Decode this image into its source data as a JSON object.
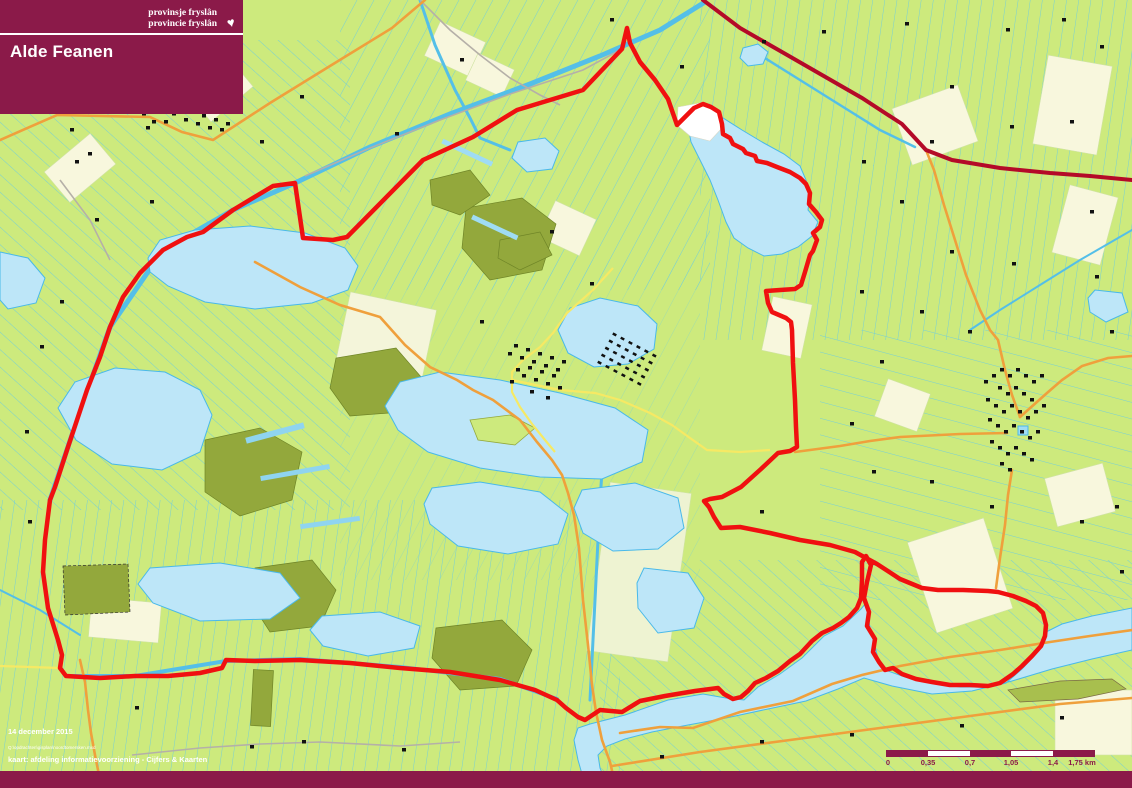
{
  "header": {
    "logo_line1": "provinsje fryslân",
    "logo_line2": "provincie fryslân",
    "heart_icon": "♥",
    "title": "Alde Feanen"
  },
  "footer": {
    "date": "14 december 2015",
    "source_path": "Q:\\opdrachten\\gisplan\\noordtomersken.mxd",
    "credit": "kaart: afdeling informatievoorziening - Cijfers & Kaarten"
  },
  "scale_bar": {
    "labels": [
      "0",
      "0,35",
      "0,7",
      "1,05",
      "1,4",
      "1,75 km"
    ]
  },
  "colors": {
    "brand_maroon": "#8b1a49",
    "boundary_red": "#f01010",
    "road_dark_red": "#b40a28",
    "road_orange": "#efa03c",
    "road_yellow": "#f6e964",
    "field_green": "#cdea7d",
    "ditch_cyan": "#5ec8ee",
    "water_blue": "#bde6f8",
    "marsh_olive": "#93a83c",
    "cream_field": "#f8f7dd"
  }
}
